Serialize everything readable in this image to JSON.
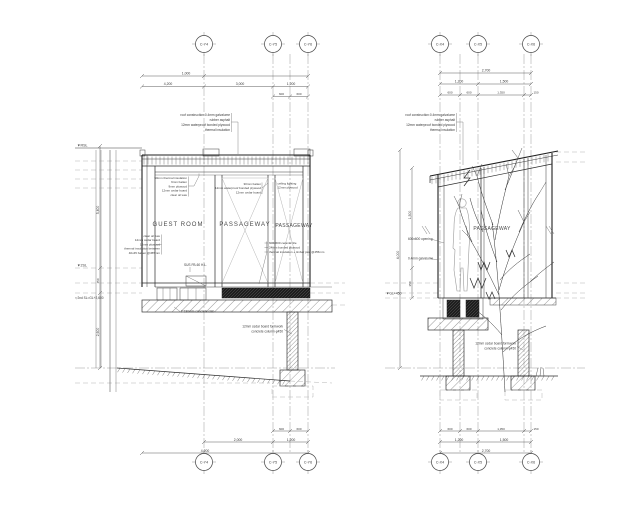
{
  "drawing": {
    "background": "#ffffff",
    "line_color": "#2b2b2b",
    "centerline_color": "#9a9a9a",
    "text_color": "#3a3a3a"
  },
  "grids": {
    "left_top": [
      "C-Y4",
      "C-Y5",
      "C-Y6"
    ],
    "right_top": [
      "C-X4",
      "C-X5",
      "C-X6"
    ],
    "left_bottom": [
      "C-Y4",
      "C-Y5",
      "C-Y6"
    ],
    "right_bottom": [
      "C-X4",
      "C-X5",
      "C-X6"
    ]
  },
  "left_section": {
    "rooms": [
      "GUEST ROOM",
      "PASSAGEWAY",
      "PASSAGEWAY"
    ],
    "roof_callout": [
      "roof construction:0.4mm galvalume",
      "rubber asphalt",
      "12mm waterproof bonded plywood",
      "thermal insulation"
    ],
    "ceiling_callout": [
      "50mm thermal insulation",
      "9mm batten",
      "9mm plywood",
      "12mm cedar board",
      "clear oil wax"
    ],
    "wall_callout": [
      "clear oil wax",
      "12mm cedar board",
      "12mm plywood",
      "thermal insulation between",
      "40x45 batten @455mm"
    ],
    "mid_callout": [
      "30mm batten",
      "12mm waterproof bonded plywood",
      "12mm cedar board"
    ],
    "edge_callout": [
      "ceiling lighting",
      "12mm plywood"
    ],
    "floor_callout": [
      "600x600 ceramic tile",
      "24mm bonded plywood",
      "thermal insulation + timber joist @455mm"
    ],
    "slab_note": "t=180mm concrete slab",
    "sus_note": "SUS FB-60 H.L.",
    "column_note": [
      "12mm cedar board formwork",
      "concrete column φ450"
    ],
    "levels": {
      "top": "▼RSL",
      "mid": "▼2SL",
      "note": "▽2nd SL=GL+2,600"
    },
    "dims_top": [
      "1,000",
      "4,200",
      "3,000",
      "1,200",
      "600",
      "600"
    ],
    "dims_bottom": [
      "600",
      "600",
      "2,000",
      "1,200",
      "4,200"
    ],
    "dims_vert": [
      "5,400",
      "450",
      "2,600"
    ]
  },
  "right_section": {
    "rooms": [
      "PASSAGEWAY"
    ],
    "roof_callout": [
      "roof construction:0.4mm galvalume",
      "rubber asphalt",
      "12mm waterproof bonded plywood",
      "thermal insulation"
    ],
    "opening_note": "600x600 opening",
    "galvalume_note": "0.4mm galvalume",
    "column_note": [
      "12mm cedar board formwork",
      "concrete column φ450"
    ],
    "levels": {
      "gl": "▼GL+450"
    },
    "dims_top": [
      "2,700",
      "1,200",
      "1,500",
      "600",
      "600",
      "1,350",
      "150"
    ],
    "dims_bottom": [
      "600",
      "600",
      "1,350",
      "150",
      "1,200",
      "1,500",
      "2,700"
    ],
    "dims_vert": [
      "1,500",
      "350",
      "4,000"
    ]
  }
}
